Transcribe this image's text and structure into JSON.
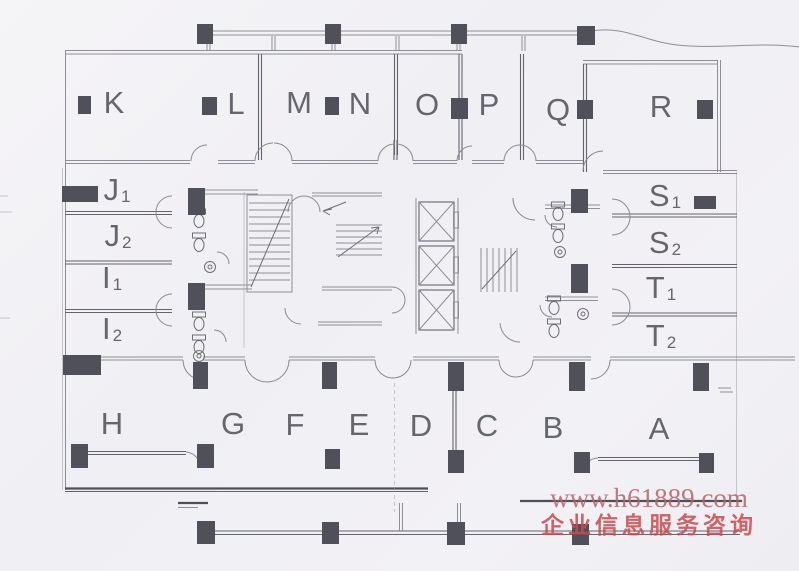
{
  "document": {
    "kind": "scanned office floor plan"
  },
  "plan": {
    "top_rooms": [
      "K",
      "L",
      "M",
      "N",
      "O",
      "P",
      "Q",
      "R"
    ],
    "bottom_rooms": [
      "H",
      "G",
      "F",
      "E",
      "D",
      "C",
      "B",
      "A"
    ],
    "left_rooms": [
      {
        "base": "J",
        "sub": "1"
      },
      {
        "base": "J",
        "sub": "2"
      },
      {
        "base": "I",
        "sub": "1"
      },
      {
        "base": "I",
        "sub": "2"
      }
    ],
    "right_rooms": [
      {
        "base": "S",
        "sub": "1"
      },
      {
        "base": "S",
        "sub": "2"
      },
      {
        "base": "T",
        "sub": "1"
      },
      {
        "base": "T",
        "sub": "2"
      }
    ]
  },
  "watermark": {
    "url": "www.h61889.com",
    "caption": "企业信息服务咨询",
    "url_color": "#b5636b",
    "caption_color": "#c94b4f"
  },
  "colors": {
    "paper": "#f1f0f4",
    "line": "#8f8f99",
    "ink_dark": "#50505a",
    "label": "#53535c"
  }
}
